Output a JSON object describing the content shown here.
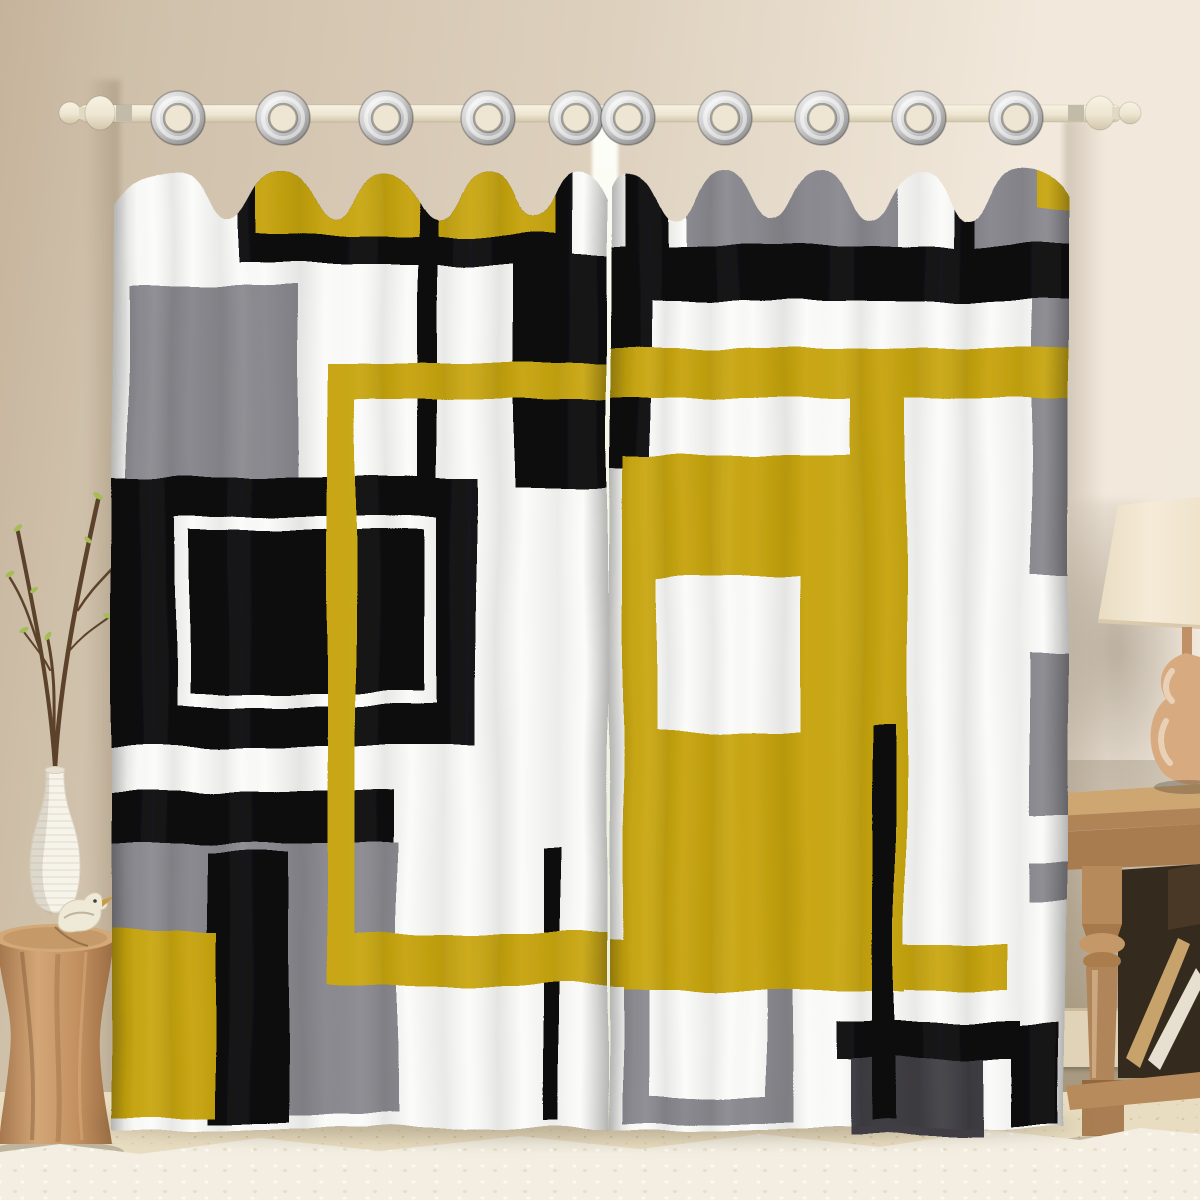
{
  "scene": {
    "type_label": "Product photo: geometric color-block grommet curtains hanging on a rod in a styled room",
    "curtain_rod": {
      "label": "cream curtain rod with turned finials"
    },
    "grommets": {
      "label": "silver metal grommets",
      "count": 10
    },
    "panels": {
      "left": {
        "label": "left curtain panel"
      },
      "right": {
        "label": "right curtain panel"
      },
      "pattern": "Mondrian-style abstract blocks and stripes in mustard yellow, black, gray and white"
    },
    "window_gap": {
      "label": "daylight showing between the two panels"
    },
    "room": {
      "wall": "warm beige wall",
      "floor": "speckled cream floor with white shag rug"
    },
    "decor": {
      "vase": "white ribbed vase with budding branches",
      "bird": "small ceramic bird figurine",
      "stool": "round carved wood stump side table",
      "rug": "white shag area rug",
      "side_table": "carved natural-wood side table",
      "lamp": "table lamp with cream drum shade and gourd base"
    }
  },
  "palette": {
    "wall_left": "#c6b39b",
    "wall_mid": "#ddd0bd",
    "wall_right": "#f2e9dc",
    "curtain_white": "#fbfbfa",
    "curtain_yellow": "#c9a712",
    "curtain_black": "#0d0d0e",
    "curtain_gray": "#8a8a90",
    "curtain_darkgray": "#3f3e44",
    "rod_cream": "#eee6d2",
    "grommet_silver": "#c9c9c9",
    "window_light": "#f2f6e4",
    "floor": "#e9ddc1",
    "rug": "#f3eee1",
    "baseboard": "#e0d3b8",
    "nook_wall": "#9c8d72",
    "stool_wood": "#bc8a5b",
    "table_wood": "#bf9a6a",
    "table_dark": "#342a1e",
    "lamp_shade": "#f2e8d3",
    "lamp_base": "#d7ab7f",
    "vase": "#f6f3ea",
    "branch": "#5c422b",
    "leaf": "#a4bd55"
  }
}
